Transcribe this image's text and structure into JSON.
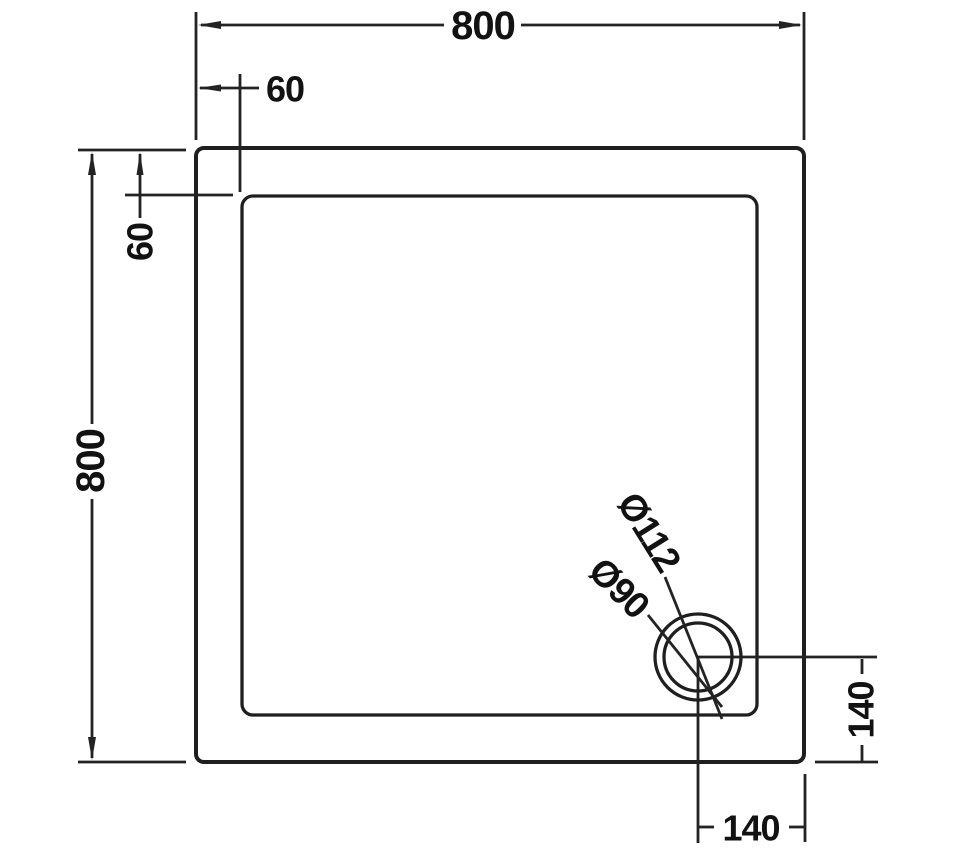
{
  "drawing": {
    "type": "technical-dimension-drawing",
    "subject": "square shower tray plan view with offset waste drain",
    "colors": {
      "background": "#ffffff",
      "line": "#232323",
      "text": "#121212"
    },
    "labels": {
      "overall_width": "800",
      "overall_height": "800",
      "rim_inset_top": "60",
      "rim_inset_left": "60",
      "drain_flange_diameter": "Ø112",
      "drain_waste_diameter": "Ø90",
      "drain_offset_from_right": "140",
      "drain_offset_from_bottom": "140"
    }
  }
}
